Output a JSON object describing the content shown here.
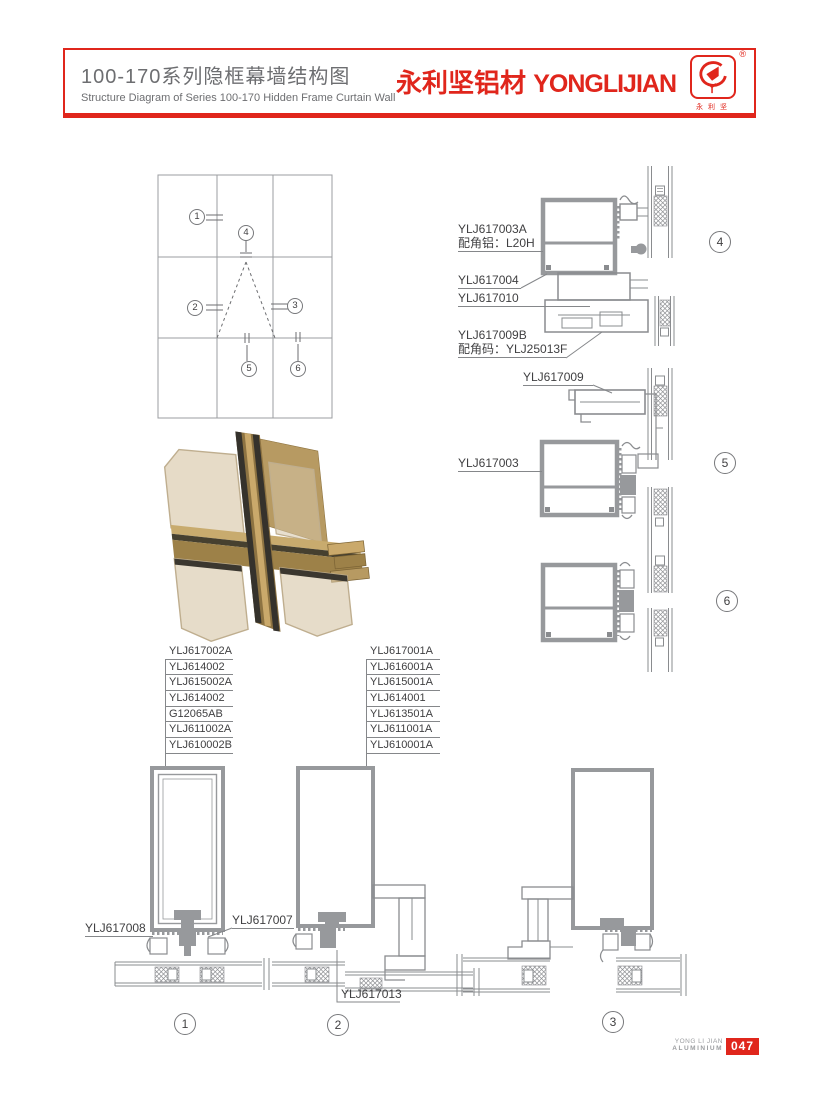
{
  "header": {
    "title_cn": "100-170系列隐框幕墙结构图",
    "title_en": "Structure Diagram of Series 100-170 Hidden Frame Curtain Wall",
    "brand_cn": "永利坚铝材",
    "brand_en": "YONGLIJIAN",
    "registered": "®",
    "logo_caption": "永利坚"
  },
  "overview": {
    "callouts": [
      "1",
      "2",
      "3",
      "4",
      "5",
      "6"
    ]
  },
  "details": {
    "d4": {
      "number": "4",
      "p1": "YLJ617003A",
      "p1_note": "配角铝：L20H",
      "p2": "YLJ617004",
      "p3": "YLJ617010",
      "p4": "YLJ617009B",
      "p4_note": "配角码：YLJ25013F"
    },
    "d5": {
      "number": "5",
      "p1": "YLJ617009",
      "p2": "YLJ617003"
    },
    "d6": {
      "number": "6"
    },
    "b1": {
      "number": "1",
      "p1": "YLJ617008",
      "p2": "YLJ617007"
    },
    "b2": {
      "number": "2",
      "p1": "YLJ617013"
    },
    "b3": {
      "number": "3"
    }
  },
  "parts_left": [
    "YLJ617002A",
    "YLJ614002",
    "YLJ615002A",
    "YLJ614002",
    "G12065AB",
    "YLJ611002A",
    "YLJ610002B"
  ],
  "parts_right": [
    "YLJ617001A",
    "YLJ616001A",
    "YLJ615001A",
    "YLJ614001",
    "YLJ613501A",
    "YLJ611001A",
    "YLJ610001A"
  ],
  "footer": {
    "company_line1": "YONG LI JIAN",
    "company_line2": "ALUMINIUM",
    "page_number": "047"
  },
  "colors": {
    "accent": "#e0261c",
    "drawing": "#97999c",
    "text": "#404042"
  }
}
